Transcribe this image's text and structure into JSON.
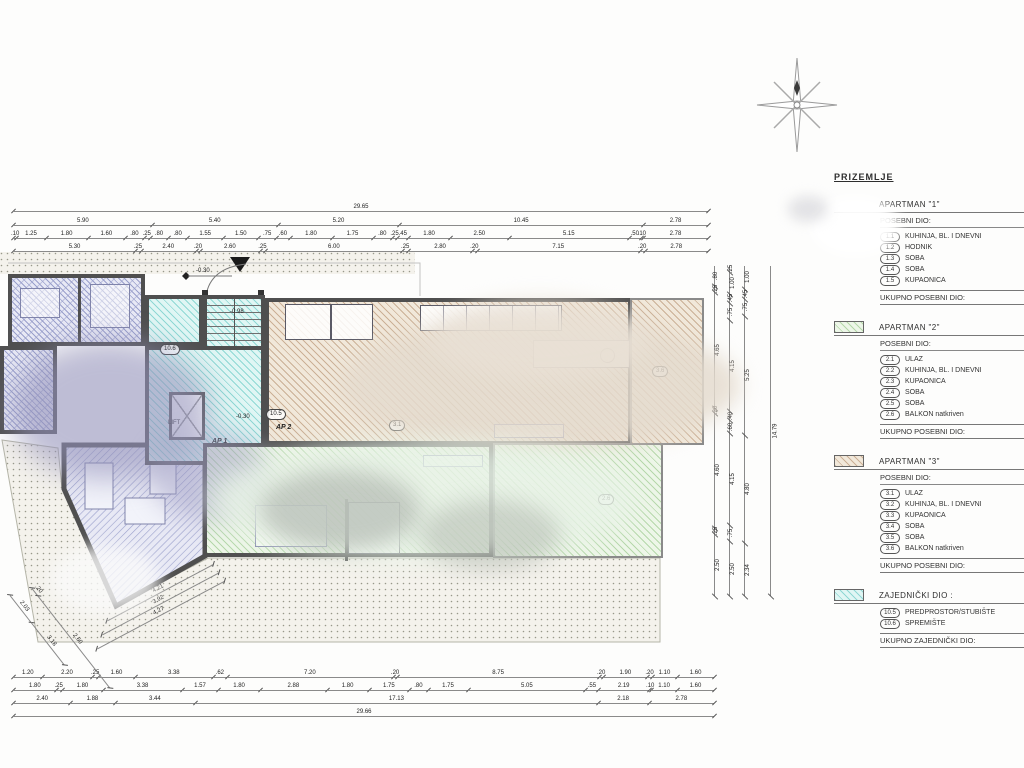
{
  "legend": {
    "title": "PRIZEMLJE",
    "sections": [
      {
        "header": "APARTMAN \"1\"",
        "subheader": "POSEBNI DIO:",
        "swatch": "none",
        "rows": [
          [
            "1.1",
            "KUHINJA, BL. I DNEVNI"
          ],
          [
            "1.2",
            "HODNIK"
          ],
          [
            "1.3",
            "SOBA"
          ],
          [
            "1.4",
            "SOBA"
          ],
          [
            "1.5",
            "KUPAONICA"
          ]
        ],
        "total": "UKUPNO POSEBNI DIO:"
      },
      {
        "header": "APARTMAN \"2\"",
        "subheader": "POSEBNI DIO:",
        "swatch": "green",
        "rows": [
          [
            "2.1",
            "ULAZ"
          ],
          [
            "2.2",
            "KUHINJA, BL. I DNEVNI"
          ],
          [
            "2.3",
            "KUPAONICA"
          ],
          [
            "2.4",
            "SOBA"
          ],
          [
            "2.5",
            "SOBA"
          ],
          [
            "2.6",
            "BALKON natkriven"
          ]
        ],
        "total": "UKUPNO POSEBNI DIO:"
      },
      {
        "header": "APARTMAN \"3\"",
        "subheader": "POSEBNI DIO:",
        "swatch": "tan",
        "rows": [
          [
            "3.1",
            "ULAZ"
          ],
          [
            "3.2",
            "KUHINJA, BL. I DNEVNI"
          ],
          [
            "3.3",
            "KUPAONICA"
          ],
          [
            "3.4",
            "SOBA"
          ],
          [
            "3.5",
            "SOBA"
          ],
          [
            "3.6",
            "BALKON natkriven"
          ]
        ],
        "total": "UKUPNO POSEBNI DIO:"
      },
      {
        "header": "ZAJEDNIČKI DIO :",
        "subheader": null,
        "swatch": "cyan",
        "rows": [
          [
            "10.5",
            "PREDPROSTOR/STUBIŠTE"
          ],
          [
            "10.6",
            "SPREMIŠTE"
          ]
        ],
        "total": "UKUPNO ZAJEDNIČKI DIO:"
      }
    ]
  },
  "plan": {
    "room_labels": {
      "r106": "10.6",
      "r105": "10.5",
      "r31": "3.1",
      "r36": "3.6",
      "r26": "2.6"
    },
    "texts": {
      "lift": "LIFT",
      "ap1": "AP 1",
      "ap2": "AP 2",
      "lvl_entry": "-0.30",
      "lvl_hall": "-0.30",
      "lvl_stair": "-0.98"
    }
  },
  "dimensions": {
    "top": [
      [
        "29.65"
      ],
      [
        "5.90",
        "5.40",
        "5.20",
        "10.45",
        "2.78"
      ],
      [
        ".10",
        "1.25",
        "1.80",
        "1.60",
        ".80",
        ".25",
        ".80",
        ".80",
        "1.55",
        "1.50",
        ".75",
        ".60",
        "1.80",
        "1.75",
        ".80",
        ".25",
        ".45",
        "1.80",
        "2.50",
        "5.15",
        ".50",
        ".10",
        "2.78"
      ],
      [
        "5.30",
        ".25",
        "2.40",
        ".20",
        "2.60",
        ".25",
        "6.00",
        ".25",
        "2.80",
        ".20",
        "7.15",
        ".20",
        "2.78"
      ]
    ],
    "bottom": [
      [
        "1.20",
        "2.20",
        ".25",
        "1.60",
        "3.38",
        ".62",
        "7.20",
        ".20",
        "8.75",
        ".20",
        "1.90",
        ".20",
        "1.10",
        "1.60"
      ],
      [
        "1.80",
        ".25",
        "1.80",
        "3.38",
        "1.57",
        "1.80",
        "2.88",
        "1.80",
        "1.75",
        ".80",
        "1.75",
        "5.05",
        ".55",
        "2.19",
        ".10",
        "1.10",
        "1.60"
      ],
      [
        "2.40",
        "1.88",
        "3.44",
        "17.13",
        "2.18",
        "2.78"
      ],
      [
        "29.66"
      ]
    ],
    "right": [
      [
        ".80",
        ".25",
        "4.65",
        ".20",
        "4.60",
        ".25",
        "2.50"
      ],
      [
        ".25",
        "1.00",
        ".45",
        ".75",
        "4.15",
        ".40",
        ".60",
        "4.15",
        ".75",
        "2.50"
      ],
      [
        "1.00",
        ".45",
        ".75",
        "5.25",
        "4.80",
        "2.34"
      ],
      [
        "14.79"
      ]
    ],
    "diagonal": [
      [
        "2.03",
        "3.18"
      ],
      [
        ".20",
        "2.60"
      ],
      [
        "4.21"
      ],
      [
        "3.92"
      ],
      [
        "4.27"
      ]
    ]
  },
  "colors": {
    "apt1": "#9aa0cc",
    "apt2": "#b5d8aa",
    "apt3": "#cbb096",
    "common": "#8fd8d4",
    "wall": "#4f4f4f"
  }
}
